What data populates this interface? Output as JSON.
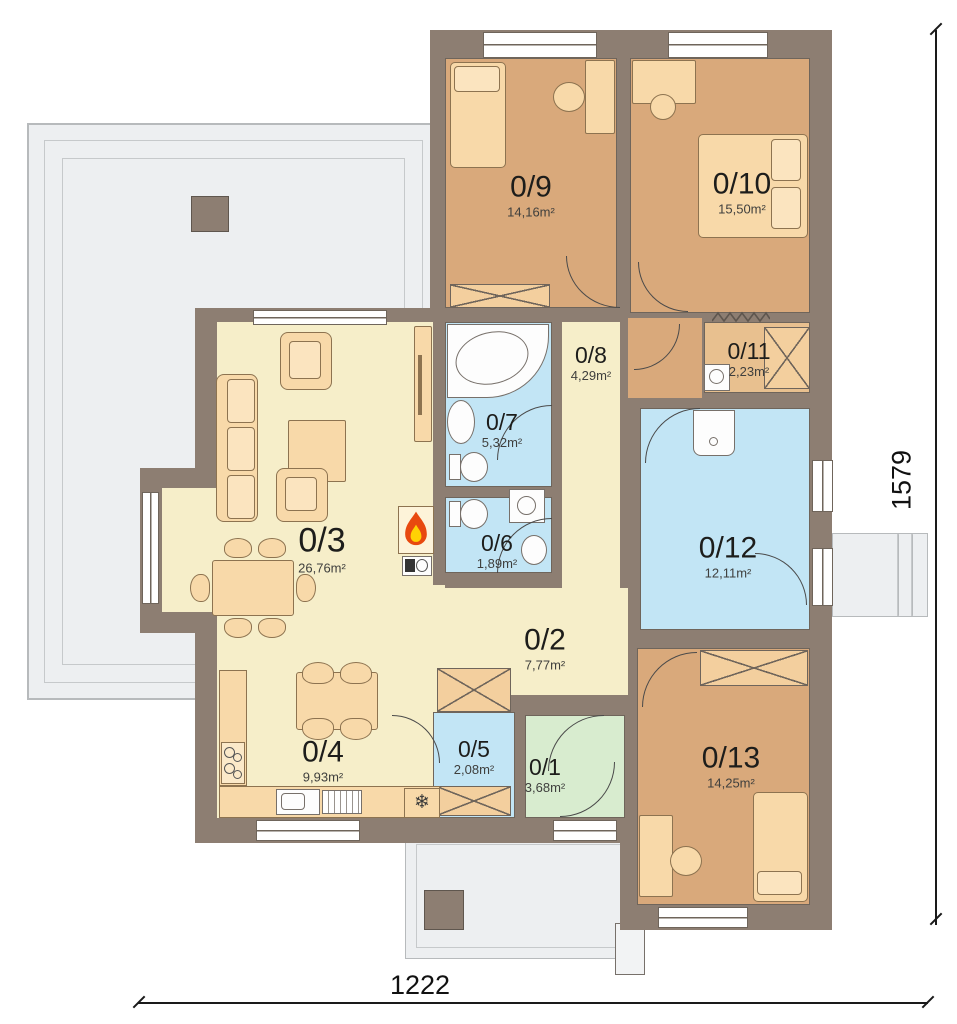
{
  "plan_title": "Single-storey house floor plan",
  "rooms": {
    "r1": {
      "code": "0/1",
      "area": "3,68m²"
    },
    "r2": {
      "code": "0/2",
      "area": "7,77m²"
    },
    "r3": {
      "code": "0/3",
      "area": "26,76m²"
    },
    "r4": {
      "code": "0/4",
      "area": "9,93m²"
    },
    "r5": {
      "code": "0/5",
      "area": "2,08m²"
    },
    "r6": {
      "code": "0/6",
      "area": "1,89m²"
    },
    "r7": {
      "code": "0/7",
      "area": "5,32m²"
    },
    "r8": {
      "code": "0/8",
      "area": "4,29m²"
    },
    "r9": {
      "code": "0/9",
      "area": "14,16m²"
    },
    "r10": {
      "code": "0/10",
      "area": "15,50m²"
    },
    "r11": {
      "code": "0/11",
      "area": "2,23m²"
    },
    "r12": {
      "code": "0/12",
      "area": "12,11m²"
    },
    "r13": {
      "code": "0/13",
      "area": "14,25m²"
    }
  },
  "dimensions": {
    "bottom": "1222",
    "right": "1579"
  },
  "icons": {
    "fridge_snowflake": "❄"
  },
  "colors": {
    "wall": "#8d7e72",
    "bedroom_tan": "#d9a97b",
    "closet_tan": "#e8c08f",
    "living_cream": "#f6eec9",
    "bath_blue": "#c2e5f5",
    "entry_green": "#d8eccf",
    "terrace_gray": "#edeff1",
    "furniture": "#f8d9a9",
    "flame_orange": "#e8490f",
    "flame_yellow": "#ffd204"
  }
}
